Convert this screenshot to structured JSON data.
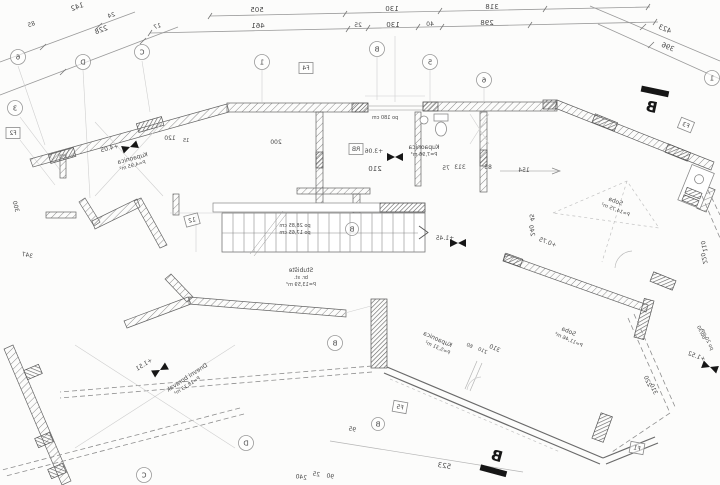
{
  "colors": {
    "paper": "#fcfcfb",
    "linework": "#9a9a9a",
    "faint_line": "#cfcfcf",
    "wall_stroke": "#666666",
    "hatch": "#8c8c8c",
    "text": "#4a4a4a",
    "marker_black": "#141414"
  },
  "dims": {
    "row1": [
      "505",
      "130",
      "318"
    ],
    "row2": [
      "461",
      "25",
      "130",
      "40",
      "298"
    ],
    "diagL": [
      "142",
      "24",
      "85",
      "228",
      "17"
    ],
    "diagR": [
      "423",
      "396"
    ],
    "m200": "200",
    "m120": "120",
    "m15": "15",
    "m210": "210",
    "m75": "75",
    "m313": "313",
    "m85": "85",
    "m154": "154",
    "m45": "45",
    "m240": "240",
    "m110": "110",
    "m220": "220",
    "m300": "300",
    "m347": "347",
    "m523": "523",
    "m25": "25",
    "m90": "90",
    "m240b": "240",
    "m95": "95",
    "m310": "310",
    "m60": "60",
    "m210b": "210",
    "po180": "po 180 cm"
  },
  "stairs": {
    "line1": "po 28,85 cm",
    "line2": "po 17,65 cm"
  },
  "bubbles": {
    "a6": "6",
    "aD": "D",
    "aC": "C",
    "a1": "1",
    "aB": "B",
    "a5": "5",
    "b6": "6",
    "b1": "1",
    "a3": "3",
    "sB": "B",
    "mB": "B",
    "bD": "D",
    "bC": "C",
    "bB": "B"
  },
  "boxes": {
    "f1": "F1",
    "f2": "F2",
    "f3": "F3",
    "f4": "F4",
    "f5": "F5",
    "rb": "RB",
    "x12": "12"
  },
  "sections": {
    "top": "B",
    "bottom": "B"
  },
  "levels": {
    "l1": "+4.05",
    "l2": "+3.06",
    "l3": "+1.45",
    "l4": "+1.51",
    "l5": "+1.52",
    "l6": "+0.75"
  },
  "notes": {
    "n1": "60/30",
    "n2": "po 20 cm"
  },
  "rooms": {
    "r1": {
      "n": "Kupaonica",
      "a": "P=4,95 m²"
    },
    "r2": {
      "n": "Kupaonica",
      "a": "P=7,96 m²"
    },
    "r3": {
      "n": "Stubište",
      "b": "br. st.",
      "a": "P=13,59 m²"
    },
    "r4": {
      "n": "Soba",
      "a": "P=14,75 m²"
    },
    "r5": {
      "n": "Soba",
      "a": "P=11,46 m²"
    },
    "r6": {
      "n": "Kupaonica",
      "a": "P=5,31 m²"
    },
    "r7": {
      "n": "Dnevni boravak",
      "a": "P=18,13 m²"
    }
  }
}
